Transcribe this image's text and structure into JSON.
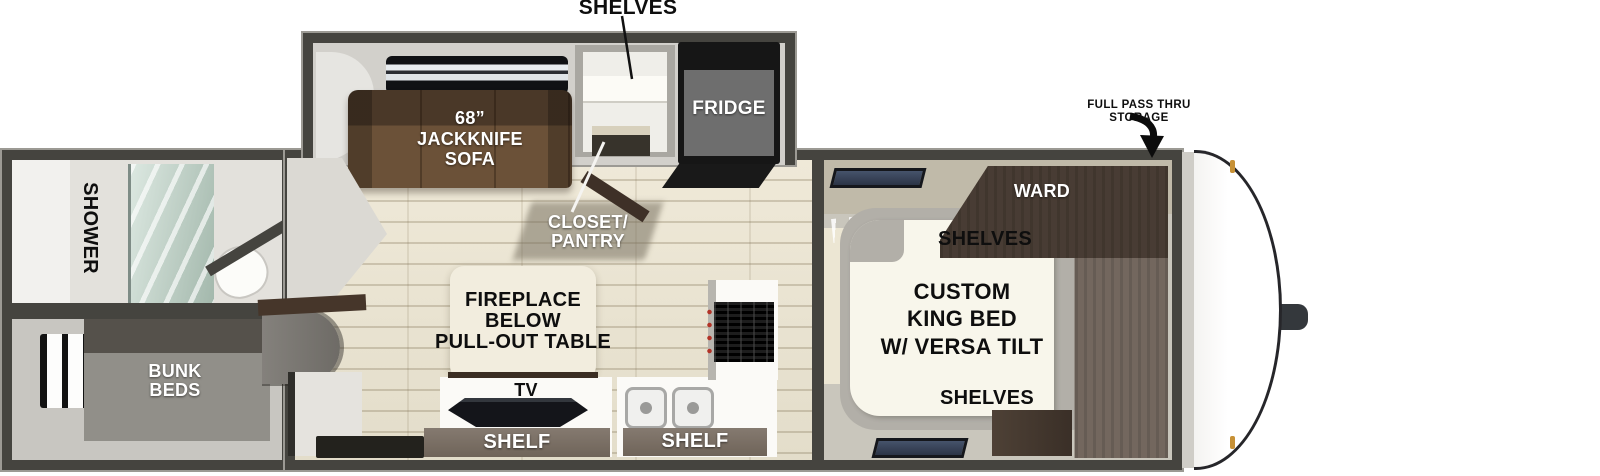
{
  "title": "Travel trailer floorplan with rear shower and bunk beds, jackknife sofa slide-out, and front custom king bed",
  "labels": {
    "shelves_top": "SHELVES",
    "sofa": [
      "68”",
      "JACKKNIFE",
      "SOFA"
    ],
    "fridge": "FRIDGE",
    "closet_pantry": [
      "CLOSET/",
      "PANTRY"
    ],
    "shower": "SHOWER",
    "bunk_beds": [
      "BUNK",
      "BEDS"
    ],
    "fireplace": [
      "FIREPLACE",
      "BELOW",
      "PULL-OUT TABLE"
    ],
    "tv": "TV",
    "shelf_left": "SHELF",
    "shelf_right": "SHELF",
    "ward": "WARD",
    "shelves_upper": "SHELVES",
    "king_bed": [
      "CUSTOM",
      "KING BED",
      "W/ VERSA TILT"
    ],
    "shelves_lower": "SHELVES",
    "pass_thru_storage": [
      "FULL PASS THRU",
      "STORAGE"
    ]
  },
  "colors": {
    "wall_dark": "#45443f",
    "floor_plank": "#ebe5d3",
    "interior_gray": "#d2d0cb",
    "sofa_brown": "#6b5138",
    "ward_brown": "#6a5e54",
    "shelf_bar": "#7b7066",
    "bunk_gray": "#918f89",
    "bed_white": "#f8f6eb",
    "counter_white": "#fbfaf7",
    "glass_green": "#b9cdc4",
    "amber_marker": "#c79136",
    "label_light": "#ffffff",
    "label_dark": "#0e0e0e"
  }
}
